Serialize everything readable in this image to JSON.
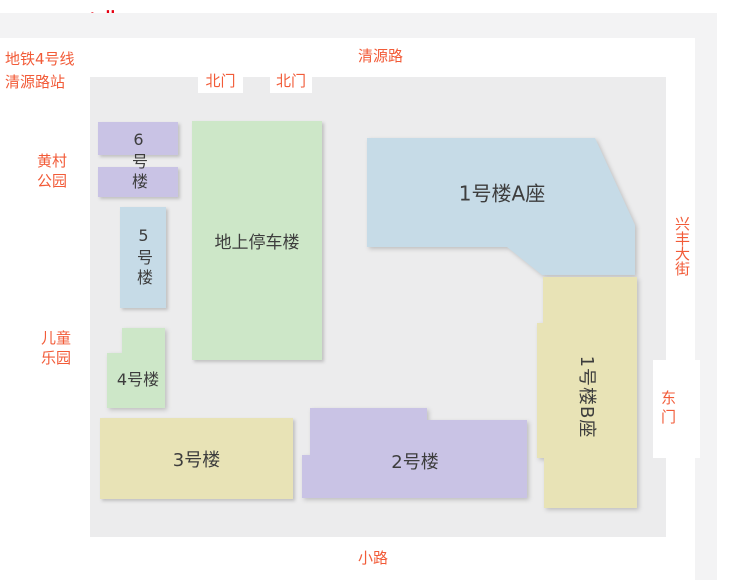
{
  "compass": {
    "arrow": "↑",
    "label": "北"
  },
  "roads": {
    "north": "清源路",
    "east": "兴丰大街",
    "south": "小路"
  },
  "landmarks": {
    "subway": {
      "line1": "地铁4号线",
      "line2": "清源路站"
    },
    "park": {
      "line1": "黄村",
      "line2": "公园"
    },
    "playground": {
      "line1": "儿童",
      "line2": "乐园"
    }
  },
  "gates": {
    "north1": "北门",
    "north2": "北门",
    "east": "东门"
  },
  "buildings": {
    "b1a": {
      "label": "1号楼A座"
    },
    "b1b": {
      "label": "1号楼B座"
    },
    "b2": {
      "label": "2号楼"
    },
    "b3": {
      "label": "3号楼"
    },
    "b4": {
      "label": "4号楼"
    },
    "b5": {
      "label": "5号楼"
    },
    "b6": {
      "label": "6号楼"
    },
    "parking": {
      "label": "地上停车楼"
    }
  },
  "colors": {
    "compass_red": "#e60012",
    "road_label_orange": "#f25b38",
    "building_lavender": "#c9c3e5",
    "building_blue": "#c6dbe7",
    "building_green": "#cde7c8",
    "building_khaki": "#e8e3b6",
    "map_background": "#ececed",
    "road_band_gray": "#f3f3f4",
    "building_text": "#3d3d3d"
  }
}
